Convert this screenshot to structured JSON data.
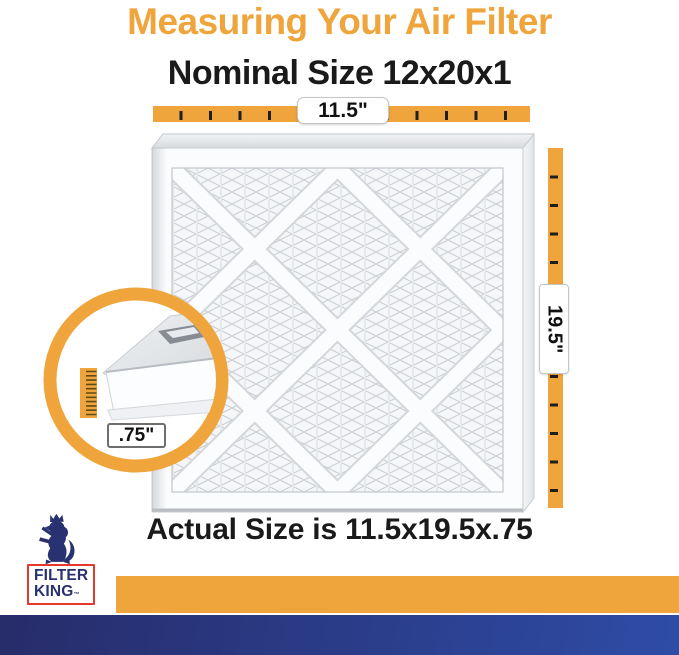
{
  "title": "Measuring Your Air Filter",
  "subtitle": "Nominal Size 12x20x1",
  "footer_text": "Actual Size is 11.5x19.5x.75",
  "measurements": {
    "width": "11.5\"",
    "height": "19.5\"",
    "depth": ".75\""
  },
  "logo": {
    "line1": "FILTER",
    "line2": "KING",
    "trademark": "™"
  },
  "colors": {
    "accent_orange": "#F0A43C",
    "heading_black": "#1A1A1A",
    "logo_red": "#E6392B",
    "logo_navy": "#2A3170",
    "bar_navy_left": "#272C6A",
    "bar_navy_right": "#2E4CA6"
  }
}
